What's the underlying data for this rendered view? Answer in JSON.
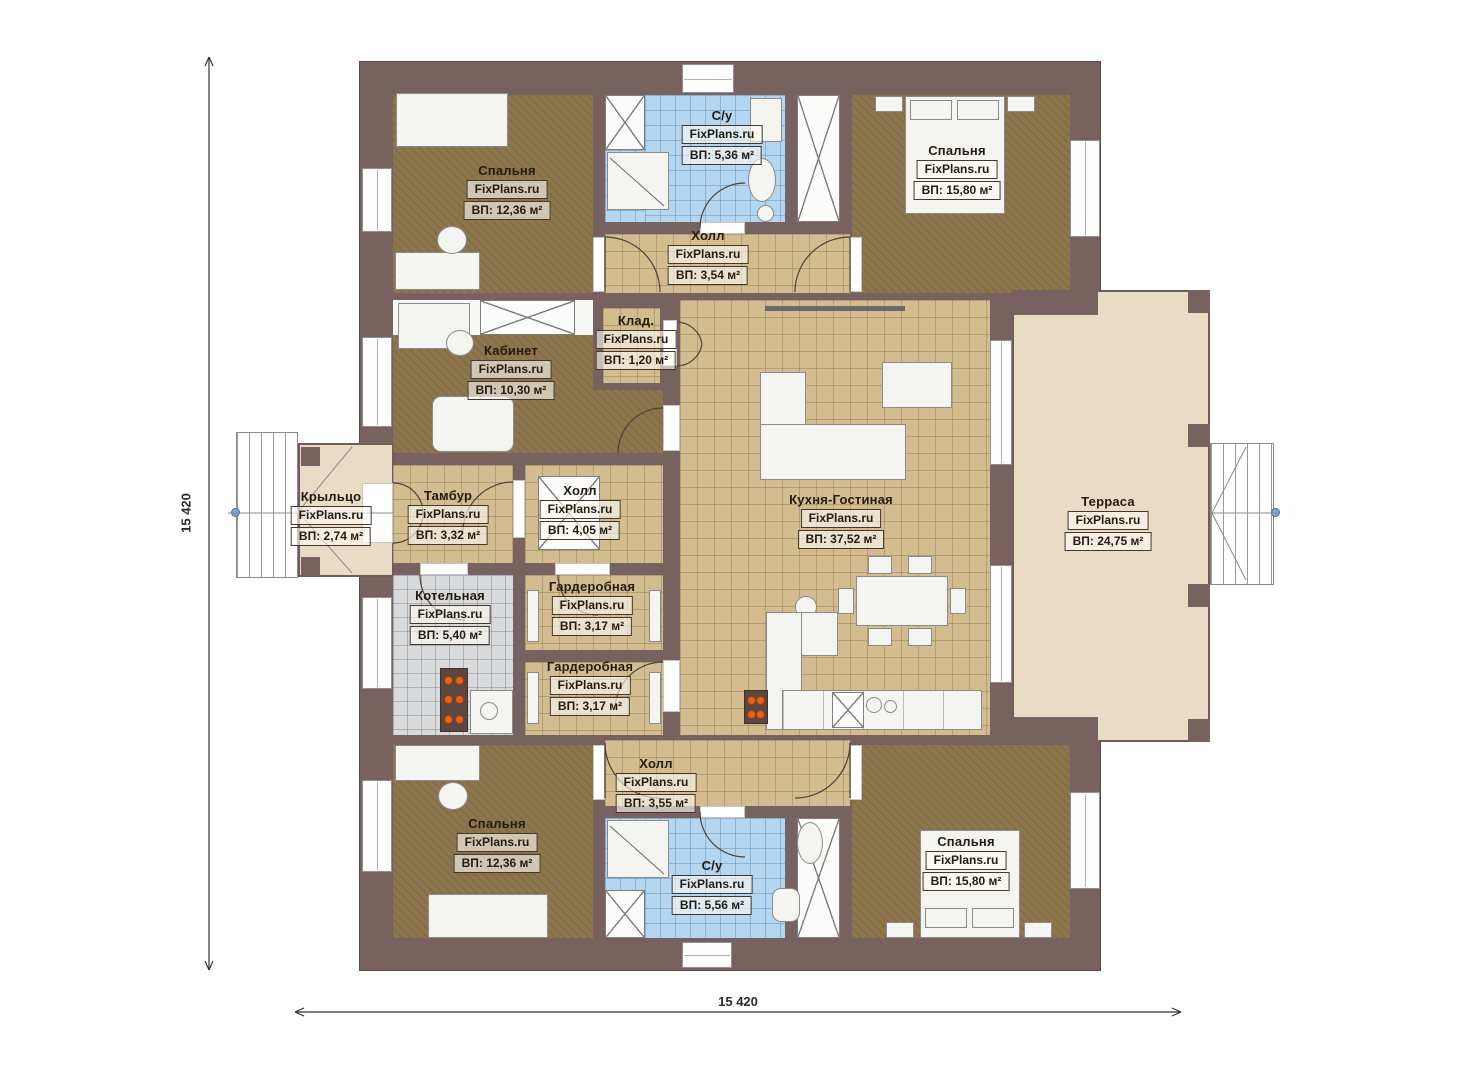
{
  "watermark": "FixPlans.ru",
  "dimensions": {
    "left": "15 420",
    "bottom": "15 420"
  },
  "rooms": [
    {
      "id": "bedroom-top-left",
      "name": "Спальня",
      "area": "ВП: 12,36 м²"
    },
    {
      "id": "bathroom-top",
      "name": "С/у",
      "area": "ВП: 5,36 м²"
    },
    {
      "id": "bedroom-top-right",
      "name": "Спальня",
      "area": "ВП: 15,80 м²"
    },
    {
      "id": "hall-top",
      "name": "Холл",
      "area": "ВП: 3,54 м²"
    },
    {
      "id": "storage",
      "name": "Клад.",
      "area": "ВП: 1,20 м²"
    },
    {
      "id": "office",
      "name": "Кабинет",
      "area": "ВП: 10,30 м²"
    },
    {
      "id": "porch",
      "name": "Крыльцо",
      "area": "ВП: 2,74 м²"
    },
    {
      "id": "vestibule",
      "name": "Тамбур",
      "area": "ВП: 3,32 м²"
    },
    {
      "id": "hall-middle",
      "name": "Холл",
      "area": "ВП: 4,05 м²"
    },
    {
      "id": "kitchen-living",
      "name": "Кухня-Гостиная",
      "area": "ВП: 37,52 м²"
    },
    {
      "id": "terrace",
      "name": "Терраса",
      "area": "ВП: 24,75 м²"
    },
    {
      "id": "boiler-room",
      "name": "Котельная",
      "area": "ВП: 5,40 м²"
    },
    {
      "id": "wardrobe-1",
      "name": "Гардеробная",
      "area": "ВП: 3,17 м²"
    },
    {
      "id": "wardrobe-2",
      "name": "Гардеробная",
      "area": "ВП: 3,17 м²"
    },
    {
      "id": "hall-bottom",
      "name": "Холл",
      "area": "ВП: 3,55 м²"
    },
    {
      "id": "bedroom-bot-left",
      "name": "Спальня",
      "area": "ВП: 12,36 м²"
    },
    {
      "id": "bathroom-bottom",
      "name": "С/у",
      "area": "ВП: 5,56 м²"
    },
    {
      "id": "bedroom-bot-right",
      "name": "Спальня",
      "area": "ВП: 15,80 м²"
    }
  ],
  "colors": {
    "wall": "#786260",
    "wood_floor": "#8d764e",
    "tile_floor": "#d3bd90",
    "bath_tile": "#b4d6f1",
    "boiler_tile": "#d9dadc",
    "terrace_floor": "#e8dcc5",
    "heater_accent": "#e8611c",
    "entry_marker": "#7aa7d8"
  }
}
